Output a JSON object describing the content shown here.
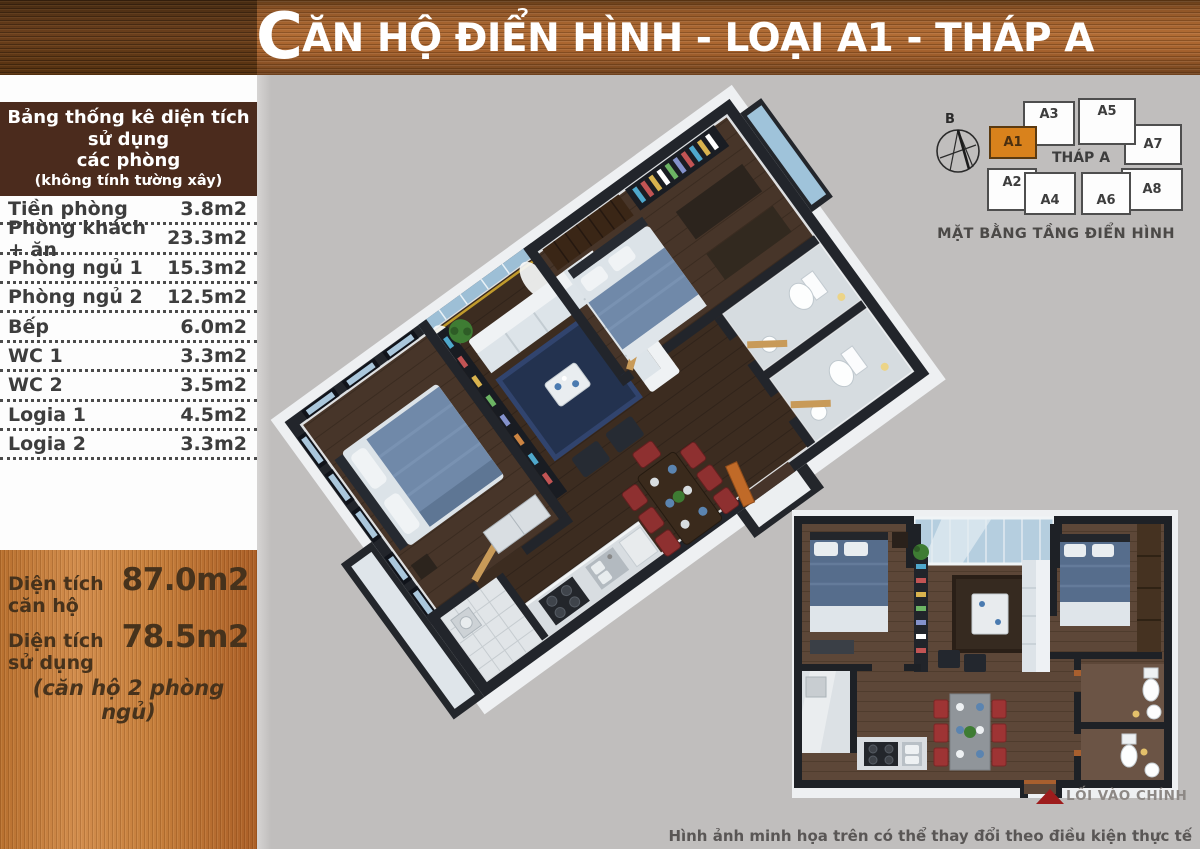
{
  "header": {
    "title_initial": "C",
    "title_rest": "ĂN HỘ ĐIỂN HÌNH - LOẠI A1 - THÁP A"
  },
  "area_table": {
    "title_line1": "Bảng thống kê diện tích sử dụng",
    "title_line2": "các phòng",
    "subtitle": "(không tính tường xây)",
    "rows": [
      {
        "label": "Tiền phòng",
        "value": "3.8m2"
      },
      {
        "label": "Phòng khách + ăn",
        "value": "23.3m2"
      },
      {
        "label": "Phòng ngủ 1",
        "value": "15.3m2"
      },
      {
        "label": "Phòng ngủ 2",
        "value": "12.5m2"
      },
      {
        "label": "Bếp",
        "value": "6.0m2"
      },
      {
        "label": "WC 1",
        "value": "3.3m2"
      },
      {
        "label": "WC 2",
        "value": "3.5m2"
      },
      {
        "label": "Logia 1",
        "value": "4.5m2"
      },
      {
        "label": "Logia 2",
        "value": "3.3m2"
      }
    ]
  },
  "summary": {
    "row1": {
      "label": "Diện tích căn hộ",
      "value": "87.0m2"
    },
    "row2": {
      "label": "Diện tích sử dụng",
      "value": "78.5m2"
    },
    "note": "(căn hộ 2 phòng ngủ)"
  },
  "tower_diagram": {
    "compass_label": "B",
    "tower_label": "THÁP A",
    "caption": "MẶT BẰNG TẦNG ĐIỂN HÌNH",
    "units": [
      {
        "id": "A1",
        "highlighted": true
      },
      {
        "id": "A2",
        "highlighted": false
      },
      {
        "id": "A3",
        "highlighted": false
      },
      {
        "id": "A4",
        "highlighted": false
      },
      {
        "id": "A5",
        "highlighted": false
      },
      {
        "id": "A6",
        "highlighted": false
      },
      {
        "id": "A7",
        "highlighted": false
      },
      {
        "id": "A8",
        "highlighted": false
      }
    ]
  },
  "floor_plan_2d": {
    "entrance_label": "LỐI VÀO CHÍNH"
  },
  "footer": {
    "disclaimer": "Hình ảnh minh họa trên có thể thay đổi theo điều kiện thực tế"
  },
  "colors": {
    "bg_gray": "#c0bebd",
    "table_header_brown": "#4b2b1d",
    "unit_highlight": "#d9821c",
    "entrance_arrow_red": "#9e1c1c"
  }
}
